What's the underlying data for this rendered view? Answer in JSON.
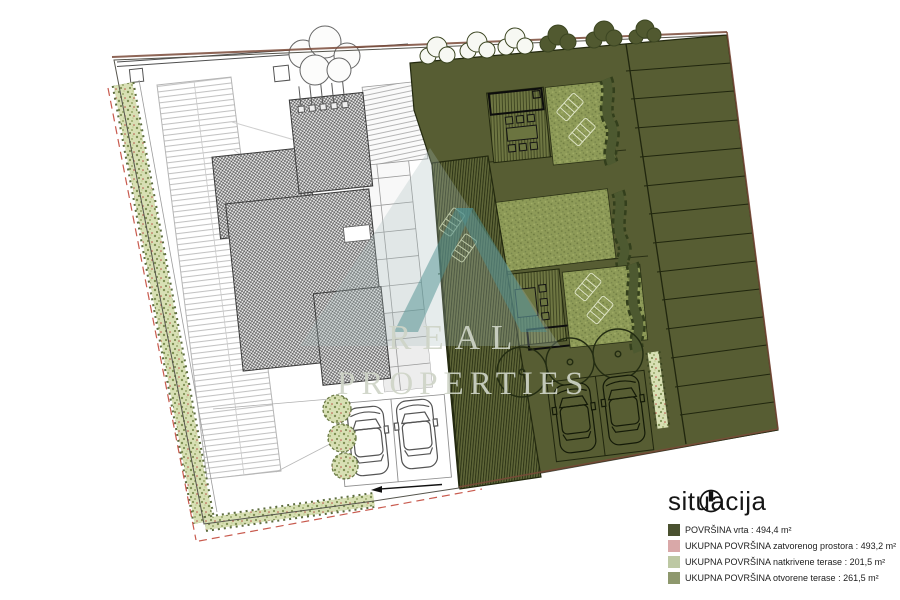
{
  "legend": {
    "title": "situacija",
    "north_icon": "north-indicator",
    "items": [
      {
        "label": "POVRŠINA vrta : 494,4 m²",
        "color": "#4a5130"
      },
      {
        "label": "UKUPNA POVRŠINA zatvorenog prostora : 493,2 m²",
        "color": "#d9a8a8"
      },
      {
        "label": "UKUPNA POVRŠINA natkrivene terase : 201,5 m²",
        "color": "#bdc8a3"
      },
      {
        "label": "UKUPNA POVRŠINA otvorene terase : 261,5 m²",
        "color": "#8e986d"
      }
    ]
  },
  "watermark": {
    "line1": "REAL",
    "line2": "PROPERTIES"
  },
  "palette": {
    "garden_olive": "#575d33",
    "lawn_green": "#8e9b58",
    "deck_olive": "#6e7642",
    "covered_terrace": "#5f6638",
    "hedge_light": "#d8e0b4",
    "boundary_brown": "#7a4a38",
    "boundary_red_dashed": "#c85a4e",
    "watermark_teal": "#4e8f8f"
  }
}
